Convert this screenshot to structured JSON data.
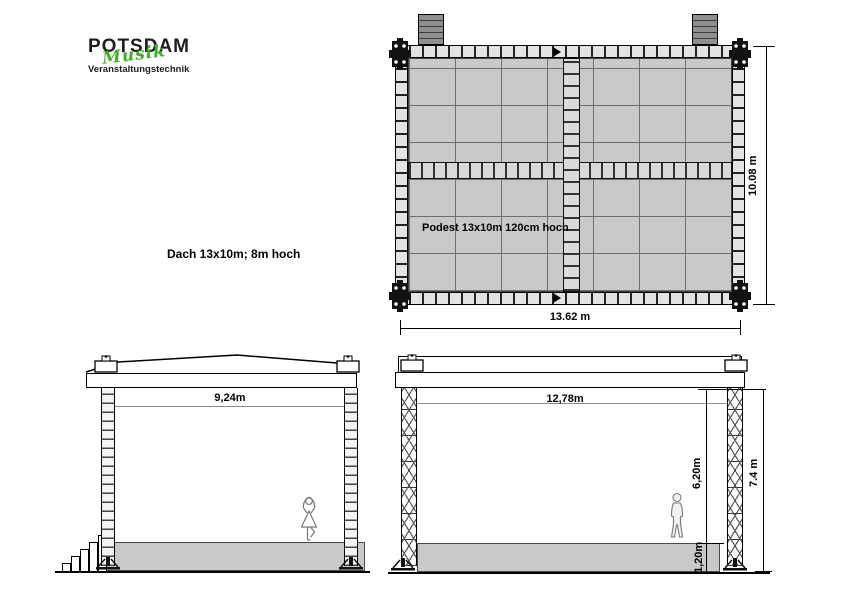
{
  "logo": {
    "title": "POTSDAM",
    "script": "Musik",
    "subtitle": "Veranstaltungstechnik",
    "accent_green": "#3fae2a",
    "text_color": "#1d1d1b"
  },
  "notes": {
    "dach": "Dach 13x10m; 8m hoch",
    "podest": "Podest 13x10m 120cm hoch"
  },
  "plan": {
    "label_width": "13.62 m",
    "label_depth": "10.08 m"
  },
  "side_elevation": {
    "label_span": "9,24m"
  },
  "front_elevation": {
    "label_span": "12,78m",
    "label_clear_height": "6,20m",
    "label_podest_height": "1,20m",
    "label_total_height": "7.4 m"
  },
  "colors": {
    "deck_fill": "#c9c9c9",
    "platform_fill": "#c9c9c9",
    "stair_block_fill": "#8f8f8f",
    "truss_line": "#000000",
    "dim_line_gray": "#8c8c8c",
    "figure_outline": "#777777"
  }
}
